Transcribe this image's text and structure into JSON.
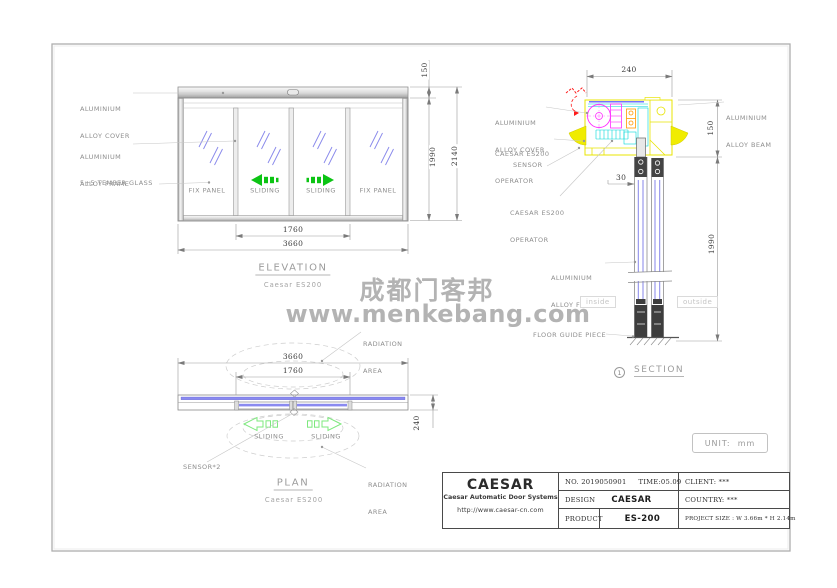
{
  "watermark": {
    "line1": "成都门客邦",
    "line2": "www.menkebang.com"
  },
  "views": {
    "elevation": {
      "title": "ELEVATION",
      "subtitle": "Caesar ES200",
      "labels": {
        "cover_line1": "ALUMINIUM",
        "cover_line2": "ALLOY COVER",
        "frame_line1": "ALUMINIUM",
        "frame_line2": "ALLOY FRAME",
        "glass": "5+5 TEMPER GLASS"
      },
      "panels": [
        "FIX PANEL",
        "SLIDING",
        "SLIDING",
        "FIX PANEL"
      ],
      "dims": {
        "sliding_width": "1760",
        "total_width": "3660",
        "cover_height": "150",
        "door_height": "1990",
        "total_height": "2140"
      }
    },
    "plan": {
      "title": "PLAN",
      "subtitle": "Caesar ES200",
      "labels": {
        "radiation_line1": "RADIATION",
        "radiation_line2": "AREA",
        "sliding_left": "SLIDING",
        "sliding_right": "SLIDING",
        "sensor": "SENSOR*2"
      },
      "dims": {
        "total_width": "3660",
        "sliding_width": "1760",
        "depth": "240"
      }
    },
    "section": {
      "title": "SECTION",
      "marker_number": "1",
      "labels": {
        "cover_line1": "ALUMINIUM",
        "cover_line2": "ALLOY COVER",
        "beam_line1": "ALUMINIUM",
        "beam_line2": "ALLOY BEAM",
        "operator_top_line1": "CAESAR ES200",
        "operator_top_line2": "OPERATOR",
        "sensor": "SENSOR",
        "operator_bottom_line1": "CAESAR ES200",
        "operator_bottom_line2": "OPERATOR",
        "frame_line1": "ALUMINIUM",
        "frame_line2": "ALLOY FRAME",
        "inside": "inside",
        "outside": "outside",
        "floor_guide": "FLOOR GUIDE PIECE"
      },
      "dims": {
        "head_width": "240",
        "head_height": "150",
        "door_gap": "30",
        "door_height": "1990"
      }
    }
  },
  "unit_note": "UNIT:  mm",
  "title_block": {
    "company": "CAESAR",
    "company_sub": "Caesar Automatic Door Systems",
    "website": "http://www.caesar-cn.com",
    "no": "NO. 2019050901",
    "time": "TIME:05.09",
    "design_label": "DESIGN",
    "design_value": "CAESAR",
    "product_label": "PRODUCT",
    "product_value": "ES-200",
    "client": "CLIENT: ***",
    "country": "COUNTRY: ***",
    "project_size": "PROJECT SIZE : W 3.66m * H 2.14m"
  },
  "colors": {
    "glass_blue": "#8585ea",
    "arrow_green": "#0cc414",
    "operator_yellow": "#f0ec00",
    "motor_magenta": "#ff2bff",
    "detail_cyan": "#00d8d8",
    "detail_orange": "#ff9a00",
    "alert_red": "#ff1a1a",
    "watermark_gray": "#b3b3b3"
  }
}
